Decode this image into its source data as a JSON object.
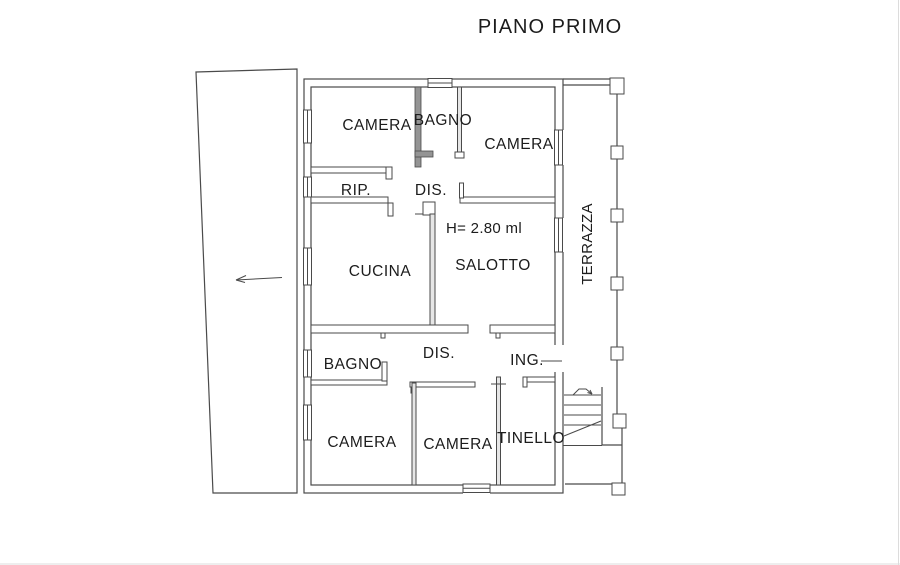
{
  "title": "PIANO PRIMO",
  "plan": {
    "rooms": {
      "camera_top_left": "CAMERA",
      "bagno_top": "BAGNO",
      "camera_top_right": "CAMERA",
      "rip": "RIP.",
      "dis_top": "DIS.",
      "cucina": "CUCINA",
      "salotto": "SALOTTO",
      "terrazza": "TERRAZZA",
      "bagno_bottom": "BAGNO",
      "dis_bottom": "DIS.",
      "ing": "ING.",
      "camera_bottom_left": "CAMERA",
      "camera_bottom_middle": "CAMERA",
      "tinello": "TINELLO"
    },
    "annotations": {
      "ceiling_height": "H= 2.80 ml"
    },
    "colors": {
      "line": "#4a4a4a",
      "structural_wall_fill": "#949494",
      "partition_wall_fill": "#e6e6e6",
      "background": "#ffffff",
      "text": "#1c1c1c"
    }
  }
}
